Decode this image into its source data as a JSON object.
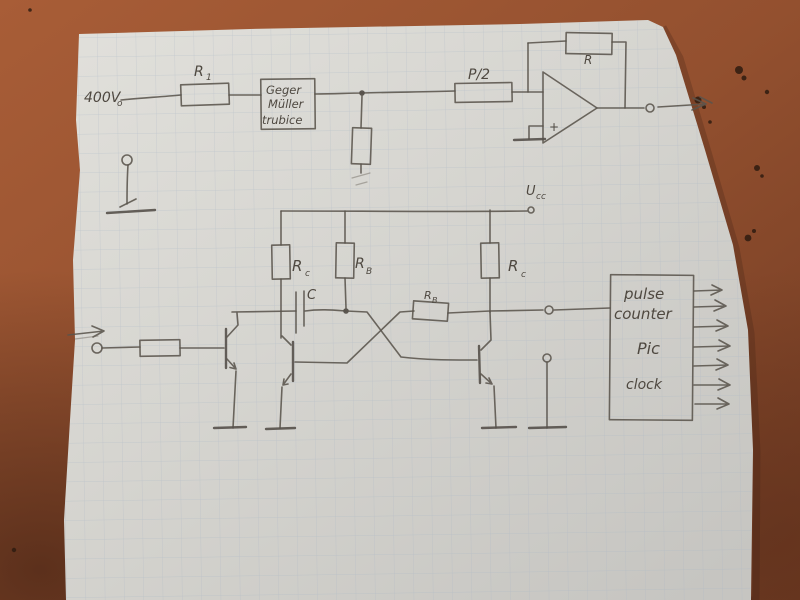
{
  "photo": {
    "desk": {
      "base_color": "#9a5130",
      "speck_color": "#2f1c10"
    },
    "paper": {
      "base_color": "#d9d8d3",
      "grid_color": "#a8b4c2"
    },
    "pencil_color": "#5a544c"
  },
  "schematic": {
    "hv_label": {
      "main": "400V",
      "sub": "o"
    },
    "r1_label": {
      "main": "R",
      "sub": "1"
    },
    "geiger_box": {
      "line1": "Geger",
      "line2": "Müller",
      "line3": "trubice"
    },
    "p2_label": "P/2",
    "feedback_r_label": "R",
    "opamp_plus": "+",
    "ucc_label": {
      "main": "U",
      "sub": "cc"
    },
    "rc_left_label": {
      "main": "R",
      "sub": "c"
    },
    "rb_mid_label": {
      "main": "R",
      "sub": "B"
    },
    "rc_right_label": {
      "main": "R",
      "sub": "c"
    },
    "cap_label": "C",
    "rb_cross_label": {
      "main": "R",
      "sub": "B"
    },
    "pulse_box": {
      "line1": "pulse",
      "line2": "counter",
      "line3": "Pic",
      "line4": "clock"
    }
  }
}
